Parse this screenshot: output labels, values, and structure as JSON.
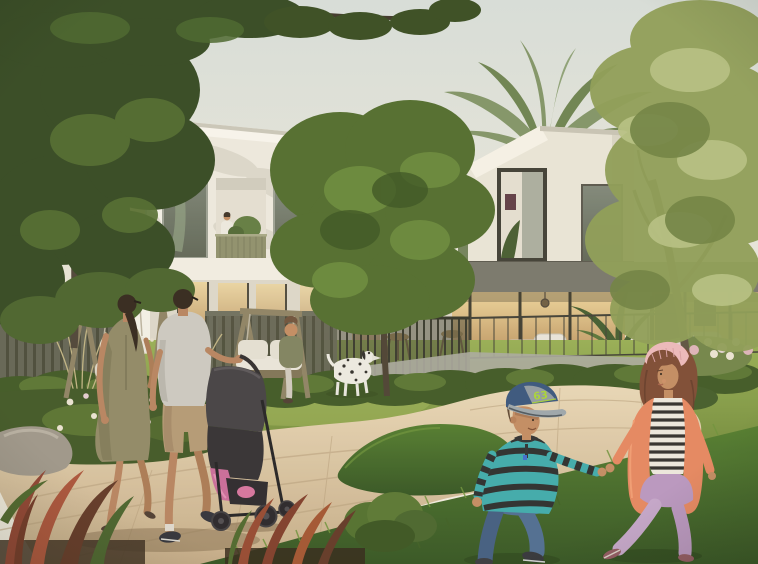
{
  "meta": {
    "width": 758,
    "height": 564
  },
  "scene": {
    "boy_cap_number": "63",
    "figures": [
      "walking-woman",
      "walking-man",
      "stroller",
      "boy-with-cap",
      "girl-with-headband",
      "woman-on-swing-bench",
      "person-on-balcony",
      "dalmatian-dog"
    ]
  },
  "palette": {
    "sky_top": "#d7dedc",
    "sky_bottom": "#f3efe4",
    "wall_white": "#edeae1",
    "wall_shaded": "#dcd8cc",
    "fascia_grey": "#75756b",
    "glass_warm_top": "#ecd49c",
    "glass_warm_bottom": "#b08654",
    "glass_cool": "#5c6456",
    "balcony_olive": "#8c8e6c",
    "foliage_dark": "#2f4520",
    "foliage_mid": "#4d6a2c",
    "foliage_light": "#8b9c55",
    "palm_green": "#7e9367",
    "trunk_brown": "#52483a",
    "lawn_light": "#95ae53",
    "lawn_dark": "#647f33",
    "grass_fg_light": "#4e7a2c",
    "grass_fg_dark": "#2f5120",
    "path_light": "#e8d7b8",
    "path_dark": "#c3ab88",
    "paving_grey": "#a7a8a0",
    "fence_wood": "#5f6153",
    "swing_wood": "#8b8164",
    "cushion_white": "#e9e6dd",
    "rock_grey": "#9b958a",
    "flower_white": "#eae3d4",
    "flower_pink": "#dcb3bc",
    "skin": "#c18a61",
    "hair_dark": "#2e231a",
    "dress_olive": "#8d8766",
    "polo_grey": "#cbc9c3",
    "shorts_khaki": "#b29875",
    "shoe_dark": "#2c2e38",
    "stroller_dark": "#3f3d42",
    "blanket_pink": "#c9699a",
    "dog_white": "#ecebe5",
    "dog_spot": "#2c2a28",
    "bench_woman_green": "#7c805f",
    "cap_navy": "#33527d",
    "cap_grey": "#8e99a3",
    "cap_number_green": "#a6d435",
    "sweater_teal": "#3aa9ad",
    "stripe_dark": "#26292c",
    "jeans_blue": "#4a6a92",
    "cardigan_coral": "#e5855f",
    "pants_lilac": "#b795c2",
    "headband_pink": "#ecb9bd",
    "girl_hair_auburn": "#7a4832"
  }
}
